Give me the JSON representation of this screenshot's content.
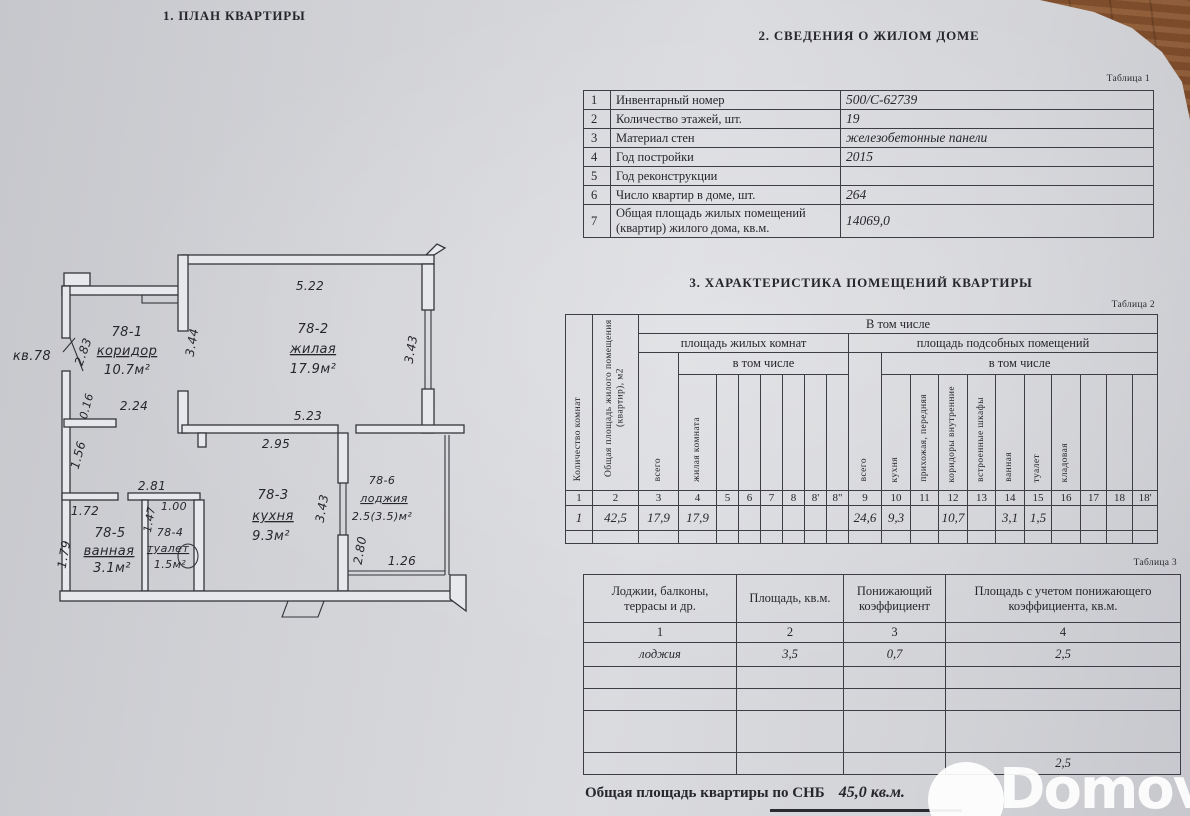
{
  "colors": {
    "paper": "#d4d5d9",
    "wood": "#8a5a38",
    "ink": "#26262c",
    "watermark": "#ffffff"
  },
  "plan": {
    "section_title": "1. ПЛАН КВАРТИРЫ",
    "apartment_label": "кв.78",
    "rooms": [
      {
        "id": "78-1",
        "name": "коридор",
        "area": "10.7м²"
      },
      {
        "id": "78-2",
        "name": "жилая",
        "area": "17.9м²"
      },
      {
        "id": "78-3",
        "name": "кухня",
        "area": "9.3м²"
      },
      {
        "id": "78-4",
        "name": "туалет",
        "area": "1.5м²"
      },
      {
        "id": "78-5",
        "name": "ванная",
        "area": "3.1м²"
      },
      {
        "id": "78-6",
        "name": "лоджия",
        "area": "2.5(3.5)м²"
      }
    ],
    "dims": {
      "living_top": "5.22",
      "living_left": "3.44",
      "living_right": "3.43",
      "living_bottom": "5.23",
      "kitchen_top": "2.95",
      "entry": "2.83",
      "corridor": "2.24",
      "niche": "0.16",
      "wall_left": "1.56",
      "bath_block": "2.81",
      "bath_top": "1.72",
      "bath_left": "1.79",
      "wc_width": "1.00",
      "wc_left": "1.47",
      "kitchen_right": "3.43",
      "loggia_left": "2.80",
      "loggia_bottom": "1.26"
    }
  },
  "building_info": {
    "section_title": "2. СВЕДЕНИЯ О ЖИЛОМ ДОМЕ",
    "table_label": "Таблица 1",
    "rows": [
      [
        "1",
        "Инвентарный номер",
        "500/С-62739"
      ],
      [
        "2",
        "Количество этажей, шт.",
        "19"
      ],
      [
        "3",
        "Материал стен",
        "железобетонные панели"
      ],
      [
        "4",
        "Год постройки",
        "2015"
      ],
      [
        "5",
        "Год реконструкции",
        ""
      ],
      [
        "6",
        "Число квартир в доме, шт.",
        "264"
      ],
      [
        "7",
        "Общая площадь жилых помещений (квартир) жилого дома, кв.м.",
        "14069,0"
      ]
    ]
  },
  "rooms_table": {
    "section_title": "3. ХАРАКТЕРИСТИКА ПОМЕЩЕНИЙ КВАРТИРЫ",
    "table_label": "Таблица 2",
    "headers": {
      "rooms_count": "Количество комнат",
      "total_area": "Общая площадь жилого помещения (квартир), м2",
      "including": "В том числе",
      "living_area": "площадь жилых комнат",
      "aux_area": "площадь подсобных помещений",
      "including2": "в том числе",
      "total": "всего",
      "living_room": "жилая комната",
      "kitchen": "кухня",
      "hallway": "прихожая, передняя",
      "corridors": "коридоры внутренние",
      "wardrobes": "встроенные шкафы",
      "bathroom": "ванная",
      "toilet": "туалет",
      "pantry": "кладовая"
    },
    "col_numbers": [
      "1",
      "2",
      "3",
      "4",
      "5",
      "6",
      "7",
      "8",
      "8'",
      "8\"",
      "9",
      "10",
      "11",
      "12",
      "13",
      "14",
      "15",
      "16",
      "17",
      "18",
      "18'"
    ],
    "values": [
      "1",
      "42,5",
      "17,9",
      "17,9",
      "",
      "",
      "",
      "",
      "",
      "",
      "24,6",
      "9,3",
      "",
      "10,7",
      "",
      "3,1",
      "1,5",
      "",
      "",
      "",
      ""
    ]
  },
  "balcony_table": {
    "table_label": "Таблица 3",
    "headers": [
      "Лоджии, балконы, террасы и др.",
      "Площадь, кв.м.",
      "Понижающий коэффициент",
      "Площадь с учетом понижающего коэффициента, кв.м."
    ],
    "col_numbers": [
      "1",
      "2",
      "3",
      "4"
    ],
    "rows": [
      [
        "лоджия",
        "3,5",
        "0,7",
        "2,5"
      ],
      [
        "",
        "",
        "",
        ""
      ],
      [
        "",
        "",
        "",
        ""
      ],
      [
        "",
        "",
        "",
        ""
      ],
      [
        "",
        "",
        "",
        "2,5"
      ]
    ]
  },
  "footer": {
    "total_label": "Общая площадь квартиры по СНБ",
    "total_value": "45,0 кв.м."
  },
  "watermark": {
    "brand": "Domovita"
  }
}
